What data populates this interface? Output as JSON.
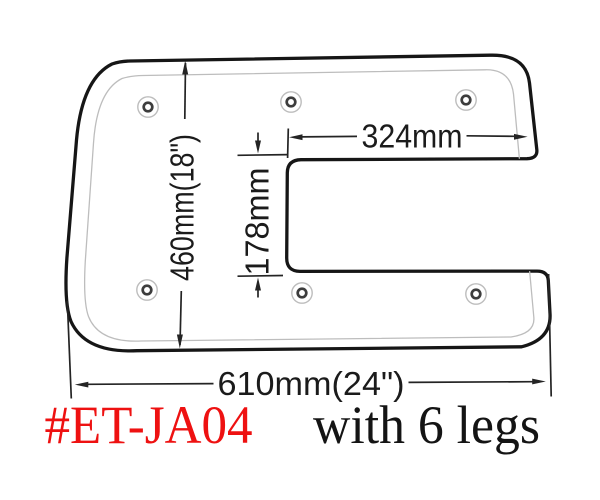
{
  "drawing": {
    "type": "technical-dimension-diagram",
    "subject": "C-shaped table base plate, top view",
    "dimensions": {
      "height_label": "460mm(18\")",
      "notch_width_label": "324mm",
      "notch_height_label": "178mm",
      "bottom_width_label": "610mm(24\")"
    },
    "plate": {
      "holes": {
        "count": 6,
        "positions": [
          {
            "x": 148,
            "y": 107
          },
          {
            "x": 291,
            "y": 102
          },
          {
            "x": 466,
            "y": 100
          },
          {
            "x": 147,
            "y": 290
          },
          {
            "x": 302,
            "y": 293
          },
          {
            "x": 476,
            "y": 294
          }
        ]
      }
    }
  },
  "footer": {
    "model_number": "#ET-JA04",
    "legs_note": "with 6 legs"
  },
  "colors": {
    "background": "#ffffff",
    "outline": "#161616",
    "inner_outline": "#bdbdbd",
    "dimension_ink": "#242424",
    "model_red": "#ee1111",
    "note_black": "#141414"
  }
}
